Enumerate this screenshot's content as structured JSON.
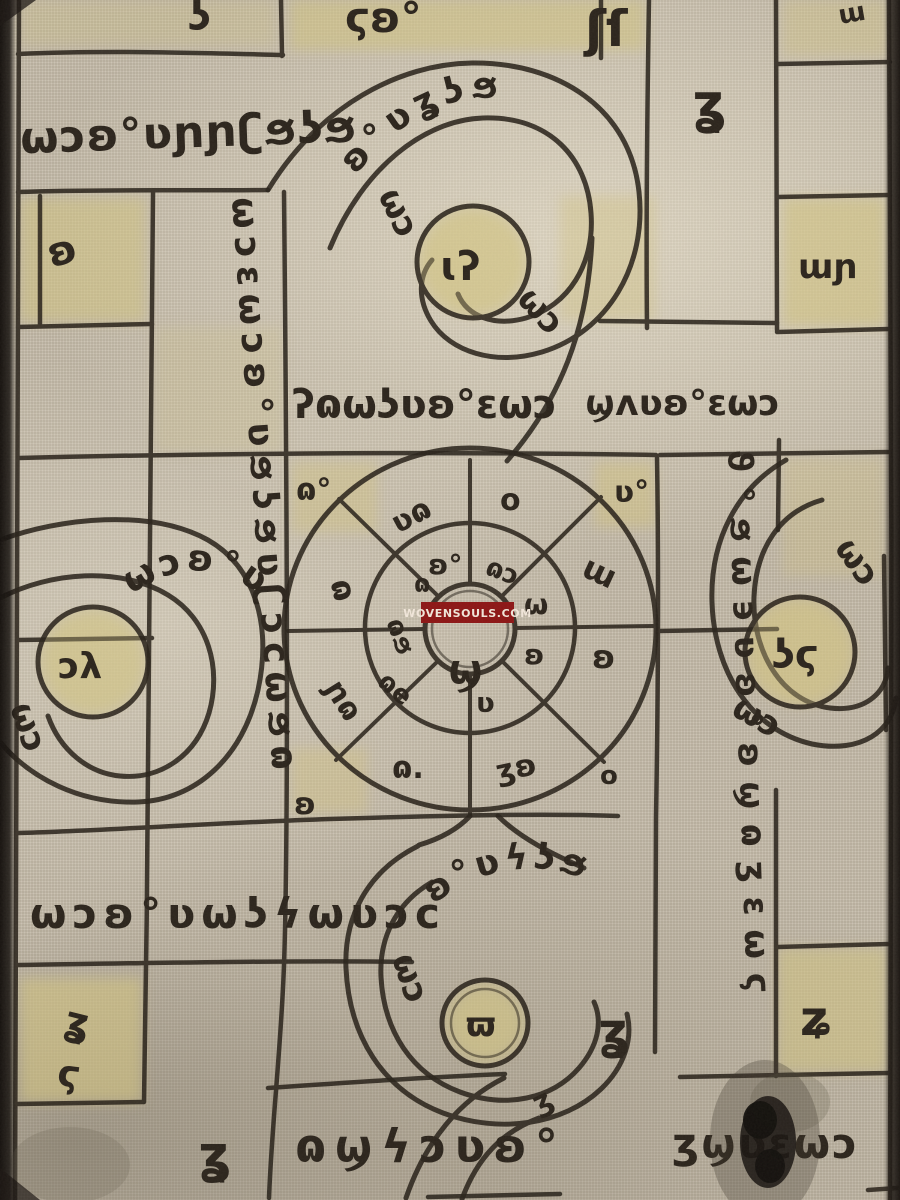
{
  "watermark": {
    "text": "WOVENSOULS.COM"
  },
  "colors": {
    "linen": "#c8bfae",
    "ink": "#2b241c",
    "wash_yellow": "#d3c482",
    "watermark_bg": "#8d1515",
    "watermark_text": "#f3e8dc"
  },
  "script_bands": {
    "top_left_row": "ωɔʚ°ʋɲɲʗϧʖϧ",
    "left_column": "ωɔɛωɔʚ°ʋϧʖϧʋʗɔcωϧɷ",
    "right_column": "ϑ°ϧω϶ʋʚ°ʚϣɷʒɛωϛ",
    "middle_row_left": "ʔɷωʖʋʚ°ɛωɔ",
    "middle_row_right": "ϣʌʋʚ°ɛωɔ",
    "lower_left_row": "ωɔʚ°ʋωʖϟωʋɔc",
    "bottom_row_left": "ɷϣϟɔʋʚ°",
    "bottom_row_right": "ʒϣʋɛωɔ",
    "top_edge_a": "ʖ",
    "top_edge_b": "ϛʚ°",
    "top_edge_c": "ʃſ",
    "top_edge_d": "ɯ"
  },
  "cells": {
    "top_left_glyph": "ʚ",
    "top_column_glyph": "ʓ",
    "top_right_glyph": "ɯɲ",
    "bottom_left_glyph_a": "ʓ",
    "bottom_left_glyph_b": "ϛ",
    "bottom_left_glyph_c": "ʓ",
    "bottom_right_glyph": "ʑ",
    "bottom_mid_glyph": "ʓ",
    "bottom_mid_glyph_small": "ʒ"
  },
  "spirals": {
    "top": {
      "center": "ɩʔ",
      "band": "ʚ°ʋʓʖϧ",
      "curl_a": "ωɔ",
      "curl_b": "ωɔ"
    },
    "left": {
      "center": "ɔλ",
      "band": "ωɔʚ°ʋ",
      "curl_a": "ωɔ"
    },
    "right": {
      "center": "ʖϛ",
      "curl_a": "ωɔ",
      "curl_b": "ωɔ"
    },
    "bottom": {
      "center": "ϖ",
      "band": "ʚ°ʋϟʖϧ",
      "curl_a": "ωɔ"
    }
  },
  "wheel": {
    "outer_n": "o",
    "outer_ne": "ɯ",
    "outer_e": "ʚ",
    "outer_se": "o",
    "outer_sse": "ʒʚ",
    "outer_s": "ɷ.",
    "outer_sw": "ɲɷ",
    "outer_w": "ɷ",
    "outer_nw": "ʋɷ",
    "mid_n": "ʚ°",
    "mid_ne": "ɷɔ",
    "mid_e": "ω",
    "mid_se": "ʚ",
    "mid_s": "ʋ",
    "mid_sw": "ɷe",
    "mid_w": "ɷϧ",
    "mid_nw": "ɷ",
    "center": "ϣ",
    "corner_nw": "ɷ°",
    "corner_ne": "ʋ°",
    "corner_sw": "ʚ"
  }
}
